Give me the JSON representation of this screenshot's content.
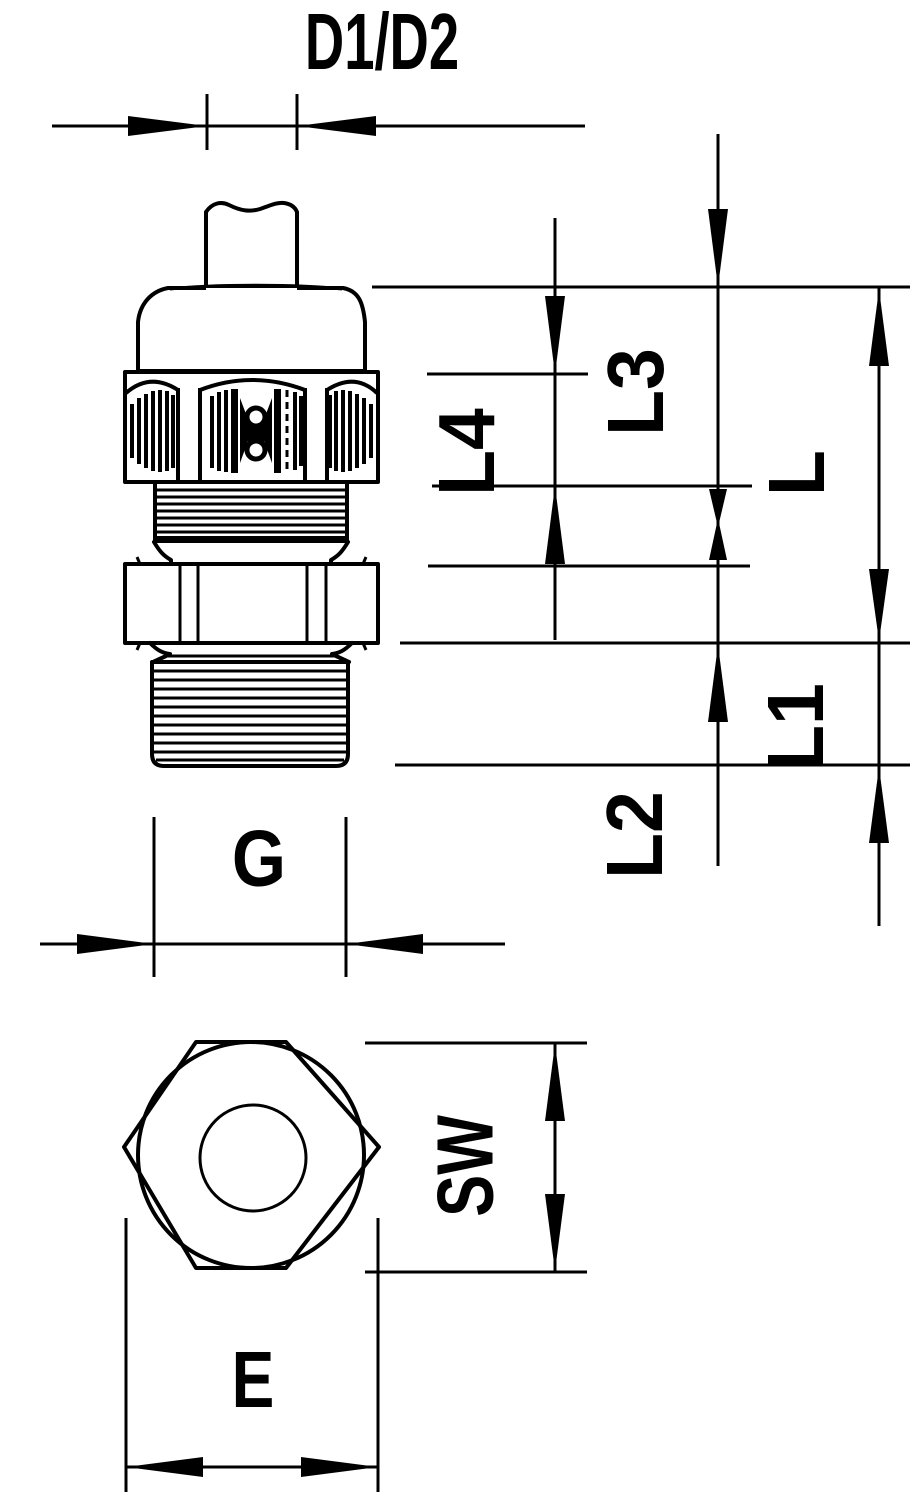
{
  "drawing": {
    "kind": "technical dimension drawing",
    "views": [
      "side view",
      "bottom view"
    ]
  },
  "dims": {
    "d1d2": "D1/D2",
    "l4": "L4",
    "l3": "L3",
    "l": "L",
    "l1": "L1",
    "l2": "L2",
    "g": "G",
    "sw": "SW",
    "e": "E"
  },
  "colors": {
    "line": "#000000",
    "background": "#ffffff"
  }
}
